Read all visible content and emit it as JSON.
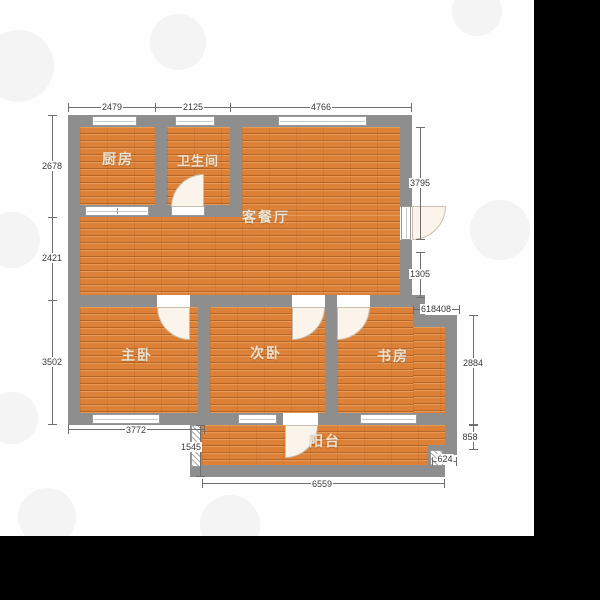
{
  "plan": {
    "rooms": [
      {
        "id": "kitchen",
        "label": "厨房"
      },
      {
        "id": "bathroom",
        "label": "卫生间"
      },
      {
        "id": "living-dining",
        "label": "客餐厅"
      },
      {
        "id": "master-bedroom",
        "label": "主卧"
      },
      {
        "id": "second-bedroom",
        "label": "次卧"
      },
      {
        "id": "study",
        "label": "书房"
      },
      {
        "id": "balcony",
        "label": "阳台"
      }
    ],
    "dimensions": {
      "top": [
        "2479",
        "2125",
        "4766"
      ],
      "left": [
        "2678",
        "2421",
        "3502"
      ],
      "right": [
        "3795",
        "1305",
        "618408",
        "2884",
        "858",
        "624"
      ],
      "bottom": [
        "3772",
        "1545",
        "6559"
      ]
    },
    "colors": {
      "background": "#000000",
      "paper": "#fefefe",
      "wall": "#8e8e8e",
      "floor": "#dd8038",
      "dimension_text": "#3a3a3a",
      "room_label": "#ece4d4"
    }
  }
}
